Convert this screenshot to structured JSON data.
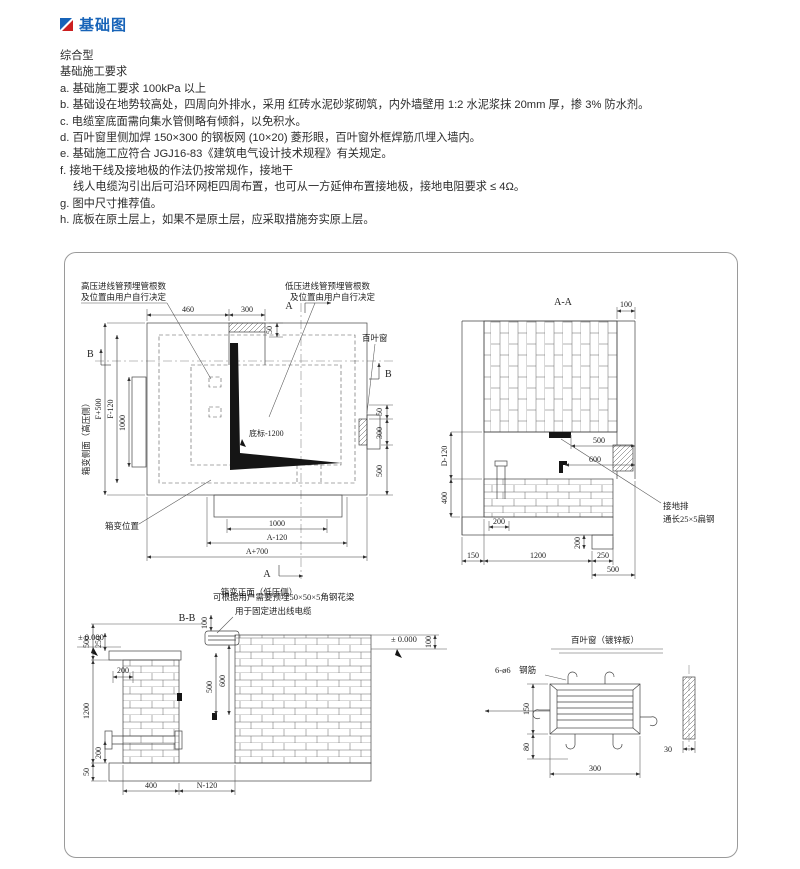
{
  "colors": {
    "accent_blue": "#1763b8",
    "accent_red": "#cc1f1f",
    "line": "#444444",
    "border": "#9a9a9a"
  },
  "header": {
    "title": "基础图"
  },
  "notes": {
    "type_label": "综合型",
    "req_label": "基础施工要求",
    "items": [
      "a. 基础施工要求 100kPa 以上",
      "b. 基础设在地势较高处，四周向外排水，采用 红砖水泥砂浆砌筑，内外墙壁用 1:2 水泥浆抹 20mm 厚，掺 3% 防水剂。",
      "c. 电缆室底面需向集水管侧略有倾斜，以免积水。",
      "d. 百叶窗里侧加焊 150×300 的钢板网 (10×20) 菱形眼，百叶窗外框焊筋爪埋入墙内。",
      "e. 基础施工应符合 JGJ16-83《建筑电气设计技术规程》有关规定。",
      "f. 接地干线及接地极的作法仍按常规作，接地干",
      "线人电缆沟引出后可沿环网柜四周布置，也可从一方延伸布置接地极，接地电阻要求 ≤ 4Ω。",
      "g. 图中尺寸推荐值。",
      "h. 底板在原土层上，如果不是原土层，应采取措施夯实原上层。"
    ]
  },
  "plan": {
    "label_hv1": "高压进线管预埋管根数",
    "label_hv2": "及位置由用户自行决定",
    "label_lv1": "低压进线管预埋管根数",
    "label_lv2": "及位置由用户自行决定",
    "label_louver": "百叶窗",
    "label_floor": "底标-1200",
    "label_box_pos": "箱变位置",
    "caption_side": "箱变侧面（高压侧）",
    "caption_front": "箱变正面（低压侧）",
    "marker_a_top": "A",
    "marker_a_bottom": "A",
    "marker_b_left": "B",
    "marker_b_right": "B",
    "dims": {
      "top_460": "460",
      "top_300": "300",
      "top_50": "50",
      "left_f500": "F+500",
      "left_f120": "F-120",
      "left_1000": "1000",
      "right_50": "50",
      "right_300": "300",
      "right_500": "500",
      "bottom_1000": "1000",
      "bottom_a120": "A-120",
      "bottom_a700": "A+700"
    }
  },
  "section_aa": {
    "title": "A-A",
    "label_ground1": "接地排",
    "label_ground2": "通长25×5扁钢",
    "dims": {
      "top_100": "100",
      "mid_500": "500",
      "mid_600": "600",
      "left_d120": "D-120",
      "left_400": "400",
      "step_200v": "200",
      "left_200h": "200",
      "bot_150": "150",
      "bot_1200": "1200",
      "bot_250": "250",
      "bot_500": "500"
    }
  },
  "section_bb": {
    "title": "B-B",
    "label_angle1": "可根据用户需要预埋50×50×5角钢花梁",
    "label_angle2": "用于固定进出线电缆",
    "level_left": "± 0.000",
    "level_right": "± 0.000",
    "dims": {
      "left_500": "500",
      "left_250": "250",
      "left_200h": "200",
      "left_1200": "1200",
      "left_200v": "200",
      "left_50": "50",
      "mid_100": "100",
      "mid_600": "600",
      "mid_500": "500",
      "right_100": "100",
      "bot_400": "400",
      "bot_n120": "N-120"
    }
  },
  "louver": {
    "title": "百叶窗（镀锌板）",
    "label_rebar": "6-ø6　钢筋",
    "dims": {
      "h_150": "150",
      "h_80": "80",
      "w_300": "300",
      "t_30": "30"
    }
  }
}
